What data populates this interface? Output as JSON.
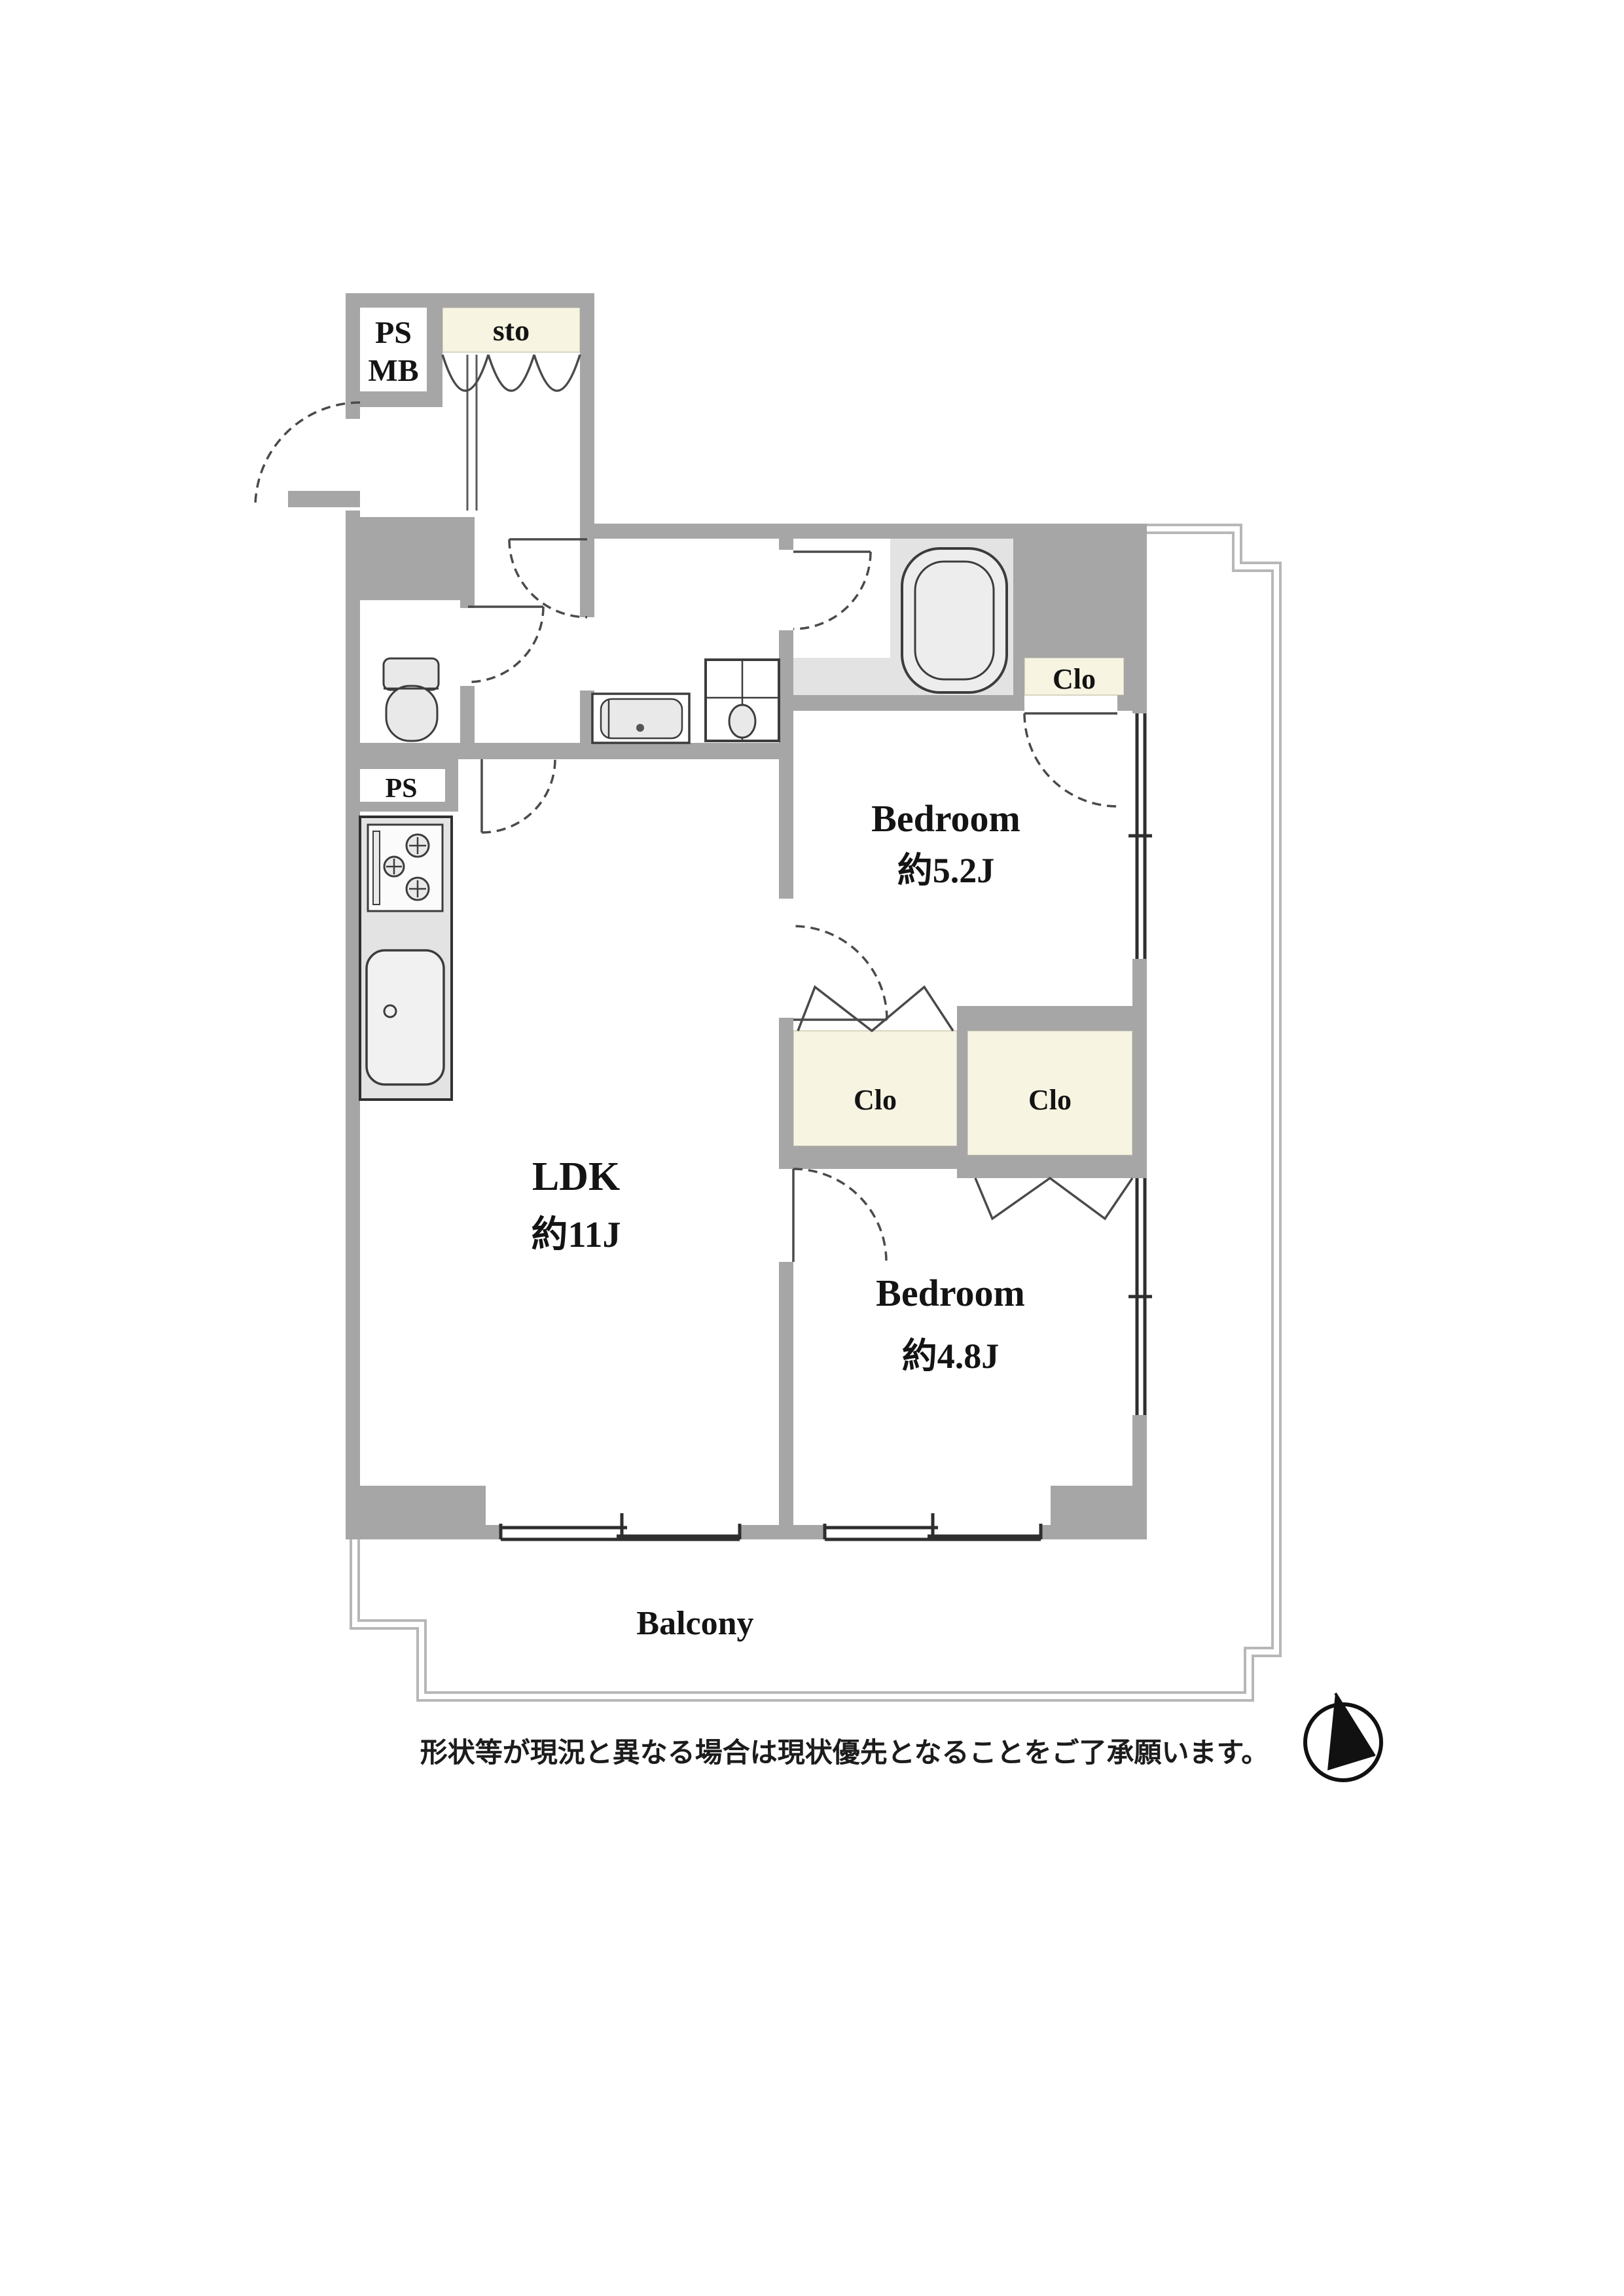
{
  "document": {
    "type": "apartment-floor-plan",
    "disclaimer": "形状等が現況と異なる場合は現状優先となることをご了承願います。"
  },
  "rooms": {
    "ldk": {
      "label": "LDK",
      "area": "約11J"
    },
    "bedroom_upper": {
      "label": "Bedroom",
      "area": "約5.2J"
    },
    "bedroom_lower": {
      "label": "Bedroom",
      "area": "約4.8J"
    },
    "balcony": {
      "label": "Balcony"
    }
  },
  "utility": {
    "pipe_space_top": "PS",
    "meter_box": "MB",
    "storage": "sto",
    "pipe_space_kitchen": "PS"
  },
  "closets": {
    "bath_side": "Clo",
    "middle_left": "Clo",
    "middle_right": "Clo"
  },
  "icons": {
    "compass": "north-arrow"
  },
  "colors": {
    "wall": "#a6a6a6",
    "closet_fill": "#f7f4e2",
    "fixture_fill": "#e9e9e9",
    "wet_floor": "#e3e3e3",
    "outline": "#3c3c3c",
    "balcony_line": "#b7b7b7",
    "text": "#141414"
  }
}
